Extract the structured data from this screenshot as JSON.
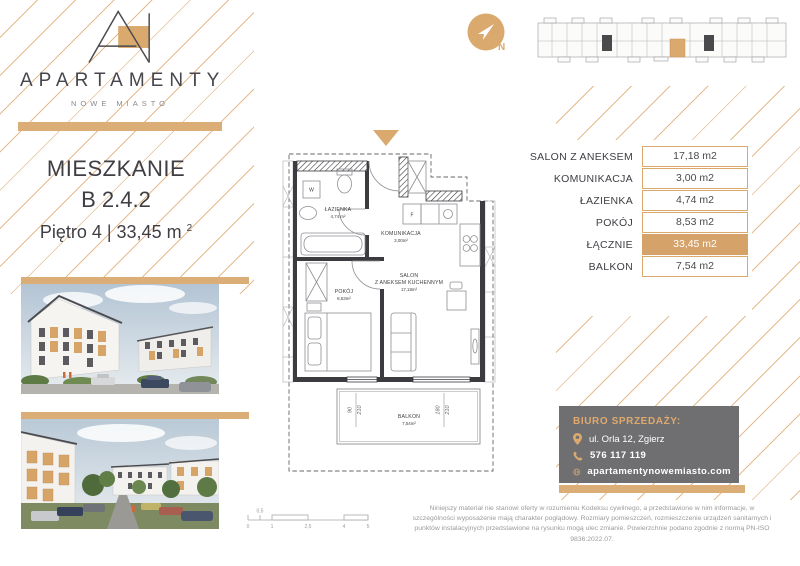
{
  "brand": {
    "name": "APARTAMENTY",
    "subtitle": "NOWE MIASTO"
  },
  "title": {
    "heading": "MIESZKANIE",
    "unit": "B 2.4.2",
    "details": "Piętro 4 | 33,45 m",
    "details_sup": "2"
  },
  "compass": {
    "label": "N"
  },
  "area_table": {
    "rows": [
      {
        "label": "SALON Z ANEKSEM",
        "value": "17,18 m2"
      },
      {
        "label": "KOMUNIKACJA",
        "value": "3,00 m2"
      },
      {
        "label": "ŁAZIENKA",
        "value": "4,74 m2"
      },
      {
        "label": "POKÓJ",
        "value": "8,53 m2"
      },
      {
        "label": "ŁĄCZNIE",
        "value": "33,45 m2"
      },
      {
        "label": "BALKON",
        "value": "7,54 m2"
      }
    ]
  },
  "plan": {
    "rooms": {
      "lazienka": {
        "name": "ŁAZIENKA",
        "area": "4,74 m²"
      },
      "komunikacja": {
        "name": "KOMUNIKACJA",
        "area": "3,00m²"
      },
      "salon": {
        "name": "SALON",
        "name2": "Z ANEKSEM KUCHENNYM",
        "area": "17,18m²"
      },
      "pokoj": {
        "name": "POKÓJ",
        "area": "8,53m²"
      },
      "balkon": {
        "name": "BALKON",
        "area": "7,54m²"
      }
    },
    "letters": {
      "washer": "W",
      "fridge": "F"
    },
    "dims": {
      "w1a": "90",
      "w1b": "210",
      "w2a": "180",
      "w2b": "210"
    }
  },
  "contact": {
    "heading": "BIURO SPRZEDAŻY:",
    "address": "ul. Orla 12, Zgierz",
    "phone": "576 117 119",
    "website": "apartamentynowemiasto.com"
  },
  "scalebar": {
    "above": "0,5",
    "ticks": [
      "0",
      "1",
      "2,5",
      "4",
      "5"
    ]
  },
  "disclaimer": "Niniejszy materiał nie stanowi oferty w rozumieniu Kodeksu cywilnego, a przedstawione w nim informacje, w szczególności wyposażenie mają charakter poglądowy. Rozmiary pomieszczeń, rozmieszczenie urządzeń sanitarnych i punktów instalacyjnych przedstawione na rysunku mogą ulec zmianie. Powierzchnie podano zgodnie z normą PN-ISO 9836:2022.07.",
  "colors": {
    "accent": "#D9A96E",
    "accent_bar": "#DCAE77",
    "hatch_line": "#E3B583",
    "dark_text": "#3E3E44",
    "contact_bg": "#6F6F72"
  }
}
